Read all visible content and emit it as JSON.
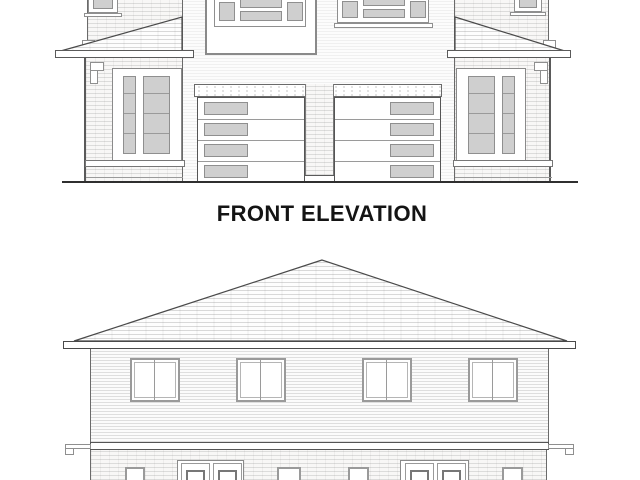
{
  "labels": {
    "front_elevation": "FRONT ELEVATION"
  },
  "drawings": {
    "front_elevation": {
      "title": "FRONT ELEVATION",
      "type": "architectural elevation, semi-detached two-storey dwelling",
      "garage_doors": 2,
      "garage_door_panels_per_door": 4,
      "garage_door_lite_columns": "left door lites on left side, right door lites on right side"
    },
    "lower_elevation": {
      "title": "",
      "type": "architectural elevation, hipped roof, label cropped below image",
      "upper_storey_windows": 4
    }
  },
  "palette": {
    "background": "#ffffff",
    "line_dark": "#3c3c3c",
    "line_mid": "#8f8f8f",
    "glass_fill": "#cfcfcf",
    "text": "#141414"
  }
}
